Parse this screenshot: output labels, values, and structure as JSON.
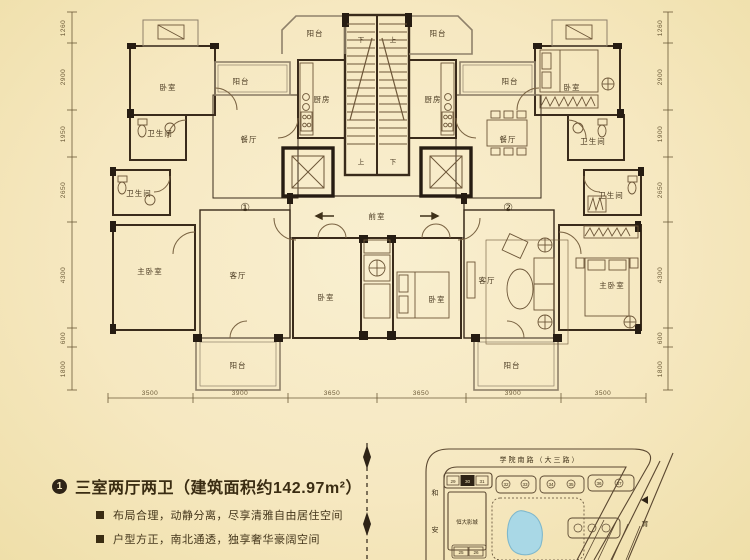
{
  "floorplan": {
    "labels": {
      "balcony": "阳台",
      "bedroom": "卧室",
      "master_bedroom": "主卧室",
      "kitchen": "厨房",
      "dining": "餐厅",
      "living": "客厅",
      "bath": "卫生间",
      "front_room": "前室",
      "up": "上",
      "down": "下",
      "unit1": "①",
      "unit2": "②"
    },
    "dims": {
      "left": [
        "1260",
        "2900",
        "1950",
        "2650",
        "4300",
        "600",
        "1800"
      ],
      "right": [
        "1260",
        "2900",
        "1900",
        "2650",
        "4300",
        "600",
        "1800"
      ],
      "bottom": [
        "3500",
        "3900",
        "3650",
        "3650",
        "3900",
        "3500"
      ]
    }
  },
  "footer": {
    "marker": "1",
    "title": "三室两厅两卫（建筑面积约142.97m²）",
    "bullets": [
      "布局合理，动静分离，尽享清雅自由居住空间",
      "户型方正，南北通透，独享奢华豪阔空间"
    ]
  },
  "map": {
    "road_top": "学院南路（大三路）",
    "road_left_chars": [
      "和",
      "安"
    ],
    "road_right": "育",
    "cinema": "恒大影城",
    "numbers": [
      "29",
      "30",
      "31",
      "25",
      "26",
      "32",
      "33",
      "34",
      "35",
      "36",
      "37"
    ]
  },
  "colors": {
    "background": "#f6e8c1",
    "wall": "#2e2316",
    "line": "#6d5638",
    "balcony_line": "#8f816a",
    "lake": "#a9d8e6",
    "text": "#3a2c12"
  }
}
